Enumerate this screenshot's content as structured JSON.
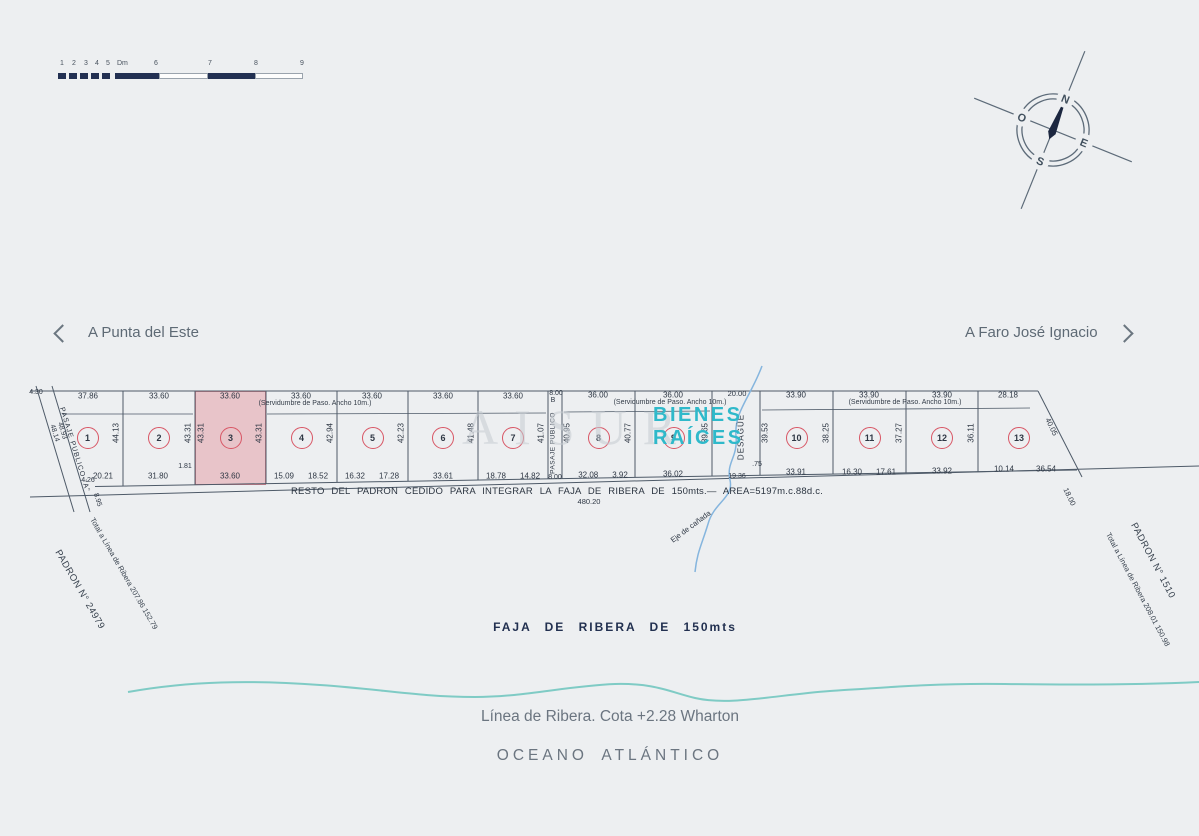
{
  "meta": {
    "background": "#edeff1",
    "ink": "#4e5a68",
    "accent_red": "#d85665",
    "navy": "#223052",
    "teal_brand": "#2fb9ca",
    "shore_teal": "#7fcbc5",
    "stream_blue": "#85b5de",
    "highlight_pink": "#e7b7be"
  },
  "scale_bar": {
    "ticks": [
      "1",
      "2",
      "3",
      "4",
      "5",
      "Dm",
      "6",
      "7",
      "8",
      "9"
    ]
  },
  "compass": {
    "n": "N",
    "e": "E",
    "s": "S",
    "o": "O"
  },
  "nav": {
    "left": "A Punta del Este",
    "right": "A Faro José Ignacio"
  },
  "watermark": {
    "big": "AISUR",
    "brand_line1": "BIENES",
    "brand_line2": "RAÍCES"
  },
  "plan": {
    "pasaje_a": {
      "label": "PASAJE PUBLICO \"A\"",
      "m1": "48.93",
      "m2": "48.14",
      "top_offset": "4.30",
      "corner": "4.26",
      "corner2": "8.95"
    },
    "pasaje_b": {
      "label": "PASAJE PUBLICO",
      "letter": "B",
      "top": "8.00",
      "bottom": "8.00"
    },
    "desague": {
      "label": "DESAGÜE",
      "top": "20.00",
      "bottom": "19.36",
      "extra": ".75"
    },
    "servidumbre_label": "(Servidumbre de Paso. Ancho 10m.)",
    "lots": [
      {
        "number": "1",
        "top": "37.86",
        "bottom": [
          "20.21"
        ],
        "right": "44.13"
      },
      {
        "number": "2",
        "top": "33.60",
        "bottom": [
          "31.80"
        ],
        "right": "43.31",
        "corner": "1.81"
      },
      {
        "number": "3",
        "top": "33.60",
        "bottom": [
          "33.60"
        ],
        "left": "43.31",
        "right": "43.31",
        "highlighted": true
      },
      {
        "number": "4",
        "top": "33.60",
        "bottom": [
          "15.09",
          "18.52"
        ],
        "right": "42.94"
      },
      {
        "number": "5",
        "top": "33.60",
        "bottom": [
          "16.32",
          "17.28"
        ],
        "right": "42.23"
      },
      {
        "number": "6",
        "top": "33.60",
        "bottom": [
          "33.61"
        ],
        "right": "41.48"
      },
      {
        "number": "7",
        "top": "33.60",
        "bottom": [
          "18.78",
          "14.82"
        ],
        "right": "41.07"
      },
      {
        "number": "8",
        "top": "36.00",
        "bottom": [
          "32.08",
          "3.92"
        ],
        "left": "40.95",
        "right": "40.77"
      },
      {
        "number": "9",
        "top": "36.00",
        "bottom": [
          "36.02"
        ],
        "right": "39.65"
      },
      {
        "number": "10",
        "top": "33.90",
        "bottom": [
          "33.91"
        ],
        "left": "39.53",
        "right": "38.25"
      },
      {
        "number": "11",
        "top": "33.90",
        "bottom": [
          "16.30",
          "17.61"
        ],
        "right": "37.27"
      },
      {
        "number": "12",
        "top": "33.90",
        "bottom": [
          "33.92"
        ],
        "right": "36.11"
      },
      {
        "number": "13",
        "top": "28.18",
        "bottom": [
          "10.14",
          "36.54"
        ],
        "diagonal": "40.05",
        "beyond": "18.00"
      }
    ],
    "resto_line": "RESTO DEL PADRON CEDIDO PARA INTEGRAR LA FAJA DE RIBERA DE 150mts.—  AREA=5197m.c.88d.c.",
    "resto_total": "480.20",
    "eje_canada": "Eje de cañada",
    "padron_left": {
      "name": "PADRON N° 24979",
      "total": "Total a Línea de Ribera 207.86   152.79"
    },
    "padron_right": {
      "name": "PADRON N° 1510",
      "total": "Total a Línea de Ribera 208.01   150.98"
    }
  },
  "coast": {
    "faja": "FAJA DE RIBERA DE 150mts",
    "linea": "Línea de Ribera. Cota +2.28 Wharton",
    "oceano": "OCEANO ATLÁNTICO"
  }
}
